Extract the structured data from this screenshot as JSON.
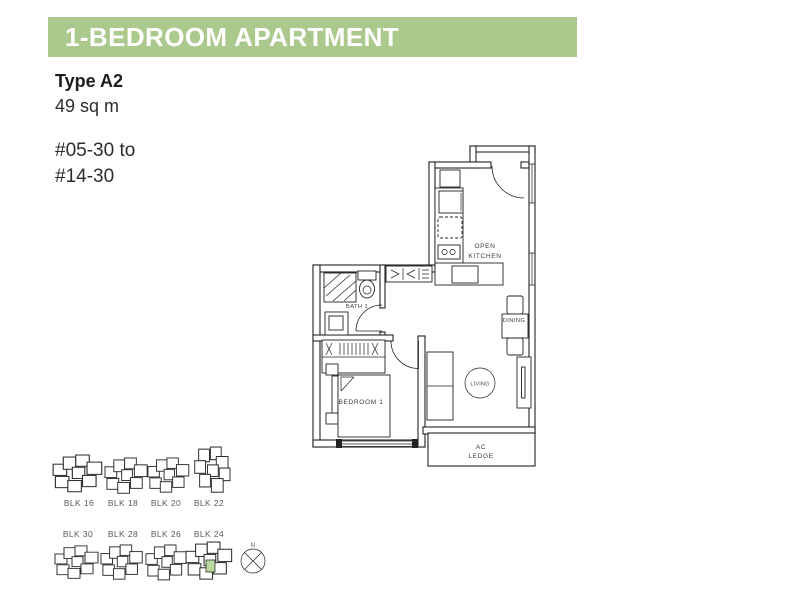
{
  "header": {
    "title": "1-BEDROOM APARTMENT"
  },
  "info": {
    "type": "Type A2",
    "area": "49 sq m",
    "units_line1": "#05-30 to",
    "units_line2": "#14-30"
  },
  "floorplan": {
    "rooms": {
      "kitchen_line1": "OPEN",
      "kitchen_line2": "KITCHEN",
      "bath": "BATH 1",
      "dining": "DINING",
      "living": "LIVING",
      "bedroom": "BEDROOM 1",
      "ac_line1": "AC",
      "ac_line2": "LEDGE"
    }
  },
  "site_map": {
    "row1": [
      {
        "label": "BLK 16"
      },
      {
        "label": "BLK 18"
      },
      {
        "label": "BLK 20"
      },
      {
        "label": "BLK 22"
      }
    ],
    "row2": [
      {
        "label": "BLK 30"
      },
      {
        "label": "BLK 28"
      },
      {
        "label": "BLK 26"
      },
      {
        "label": "BLK 24",
        "highlighted": true
      }
    ],
    "compass_north": "N"
  },
  "colors": {
    "header_bg": "#abc98d",
    "header_text": "#ffffff",
    "plan_line": "#222222",
    "plan_label": "#3c3c3c",
    "blk_label": "#595959",
    "highlight": "#b9d89b",
    "body_text": "#232323"
  }
}
